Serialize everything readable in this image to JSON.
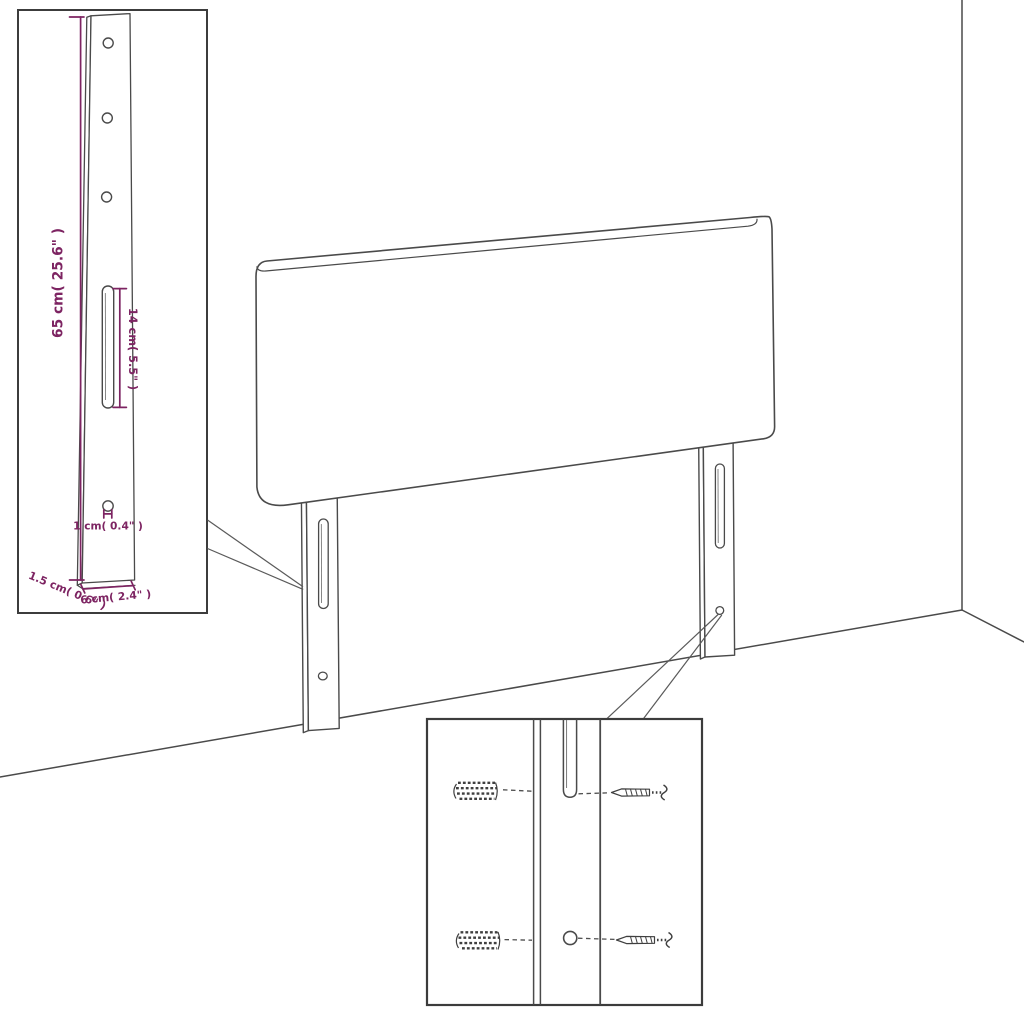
{
  "colors": {
    "background": "#ffffff",
    "drawing_line": "#4a4a4a",
    "inset_border": "#3c3c3c",
    "dimension_accent": "#7d2462"
  },
  "bracket_inset": {
    "height_label": "65 cm( 25.6\" )",
    "slot_height_label": "14 cm( 5.5\" )",
    "hole_label": "1 cm( 0.4\" )",
    "thickness_label": "1.5 cm( 0.6\" )",
    "width_label": "6 cm( 2.4\" )"
  },
  "hardware_inset": {
    "top_row": {
      "left_icon": "wall-plug-icon",
      "right_icon": "screw-icon"
    },
    "bottom_row": {
      "left_icon": "wall-plug-icon",
      "right_icon": "screw-icon"
    }
  }
}
